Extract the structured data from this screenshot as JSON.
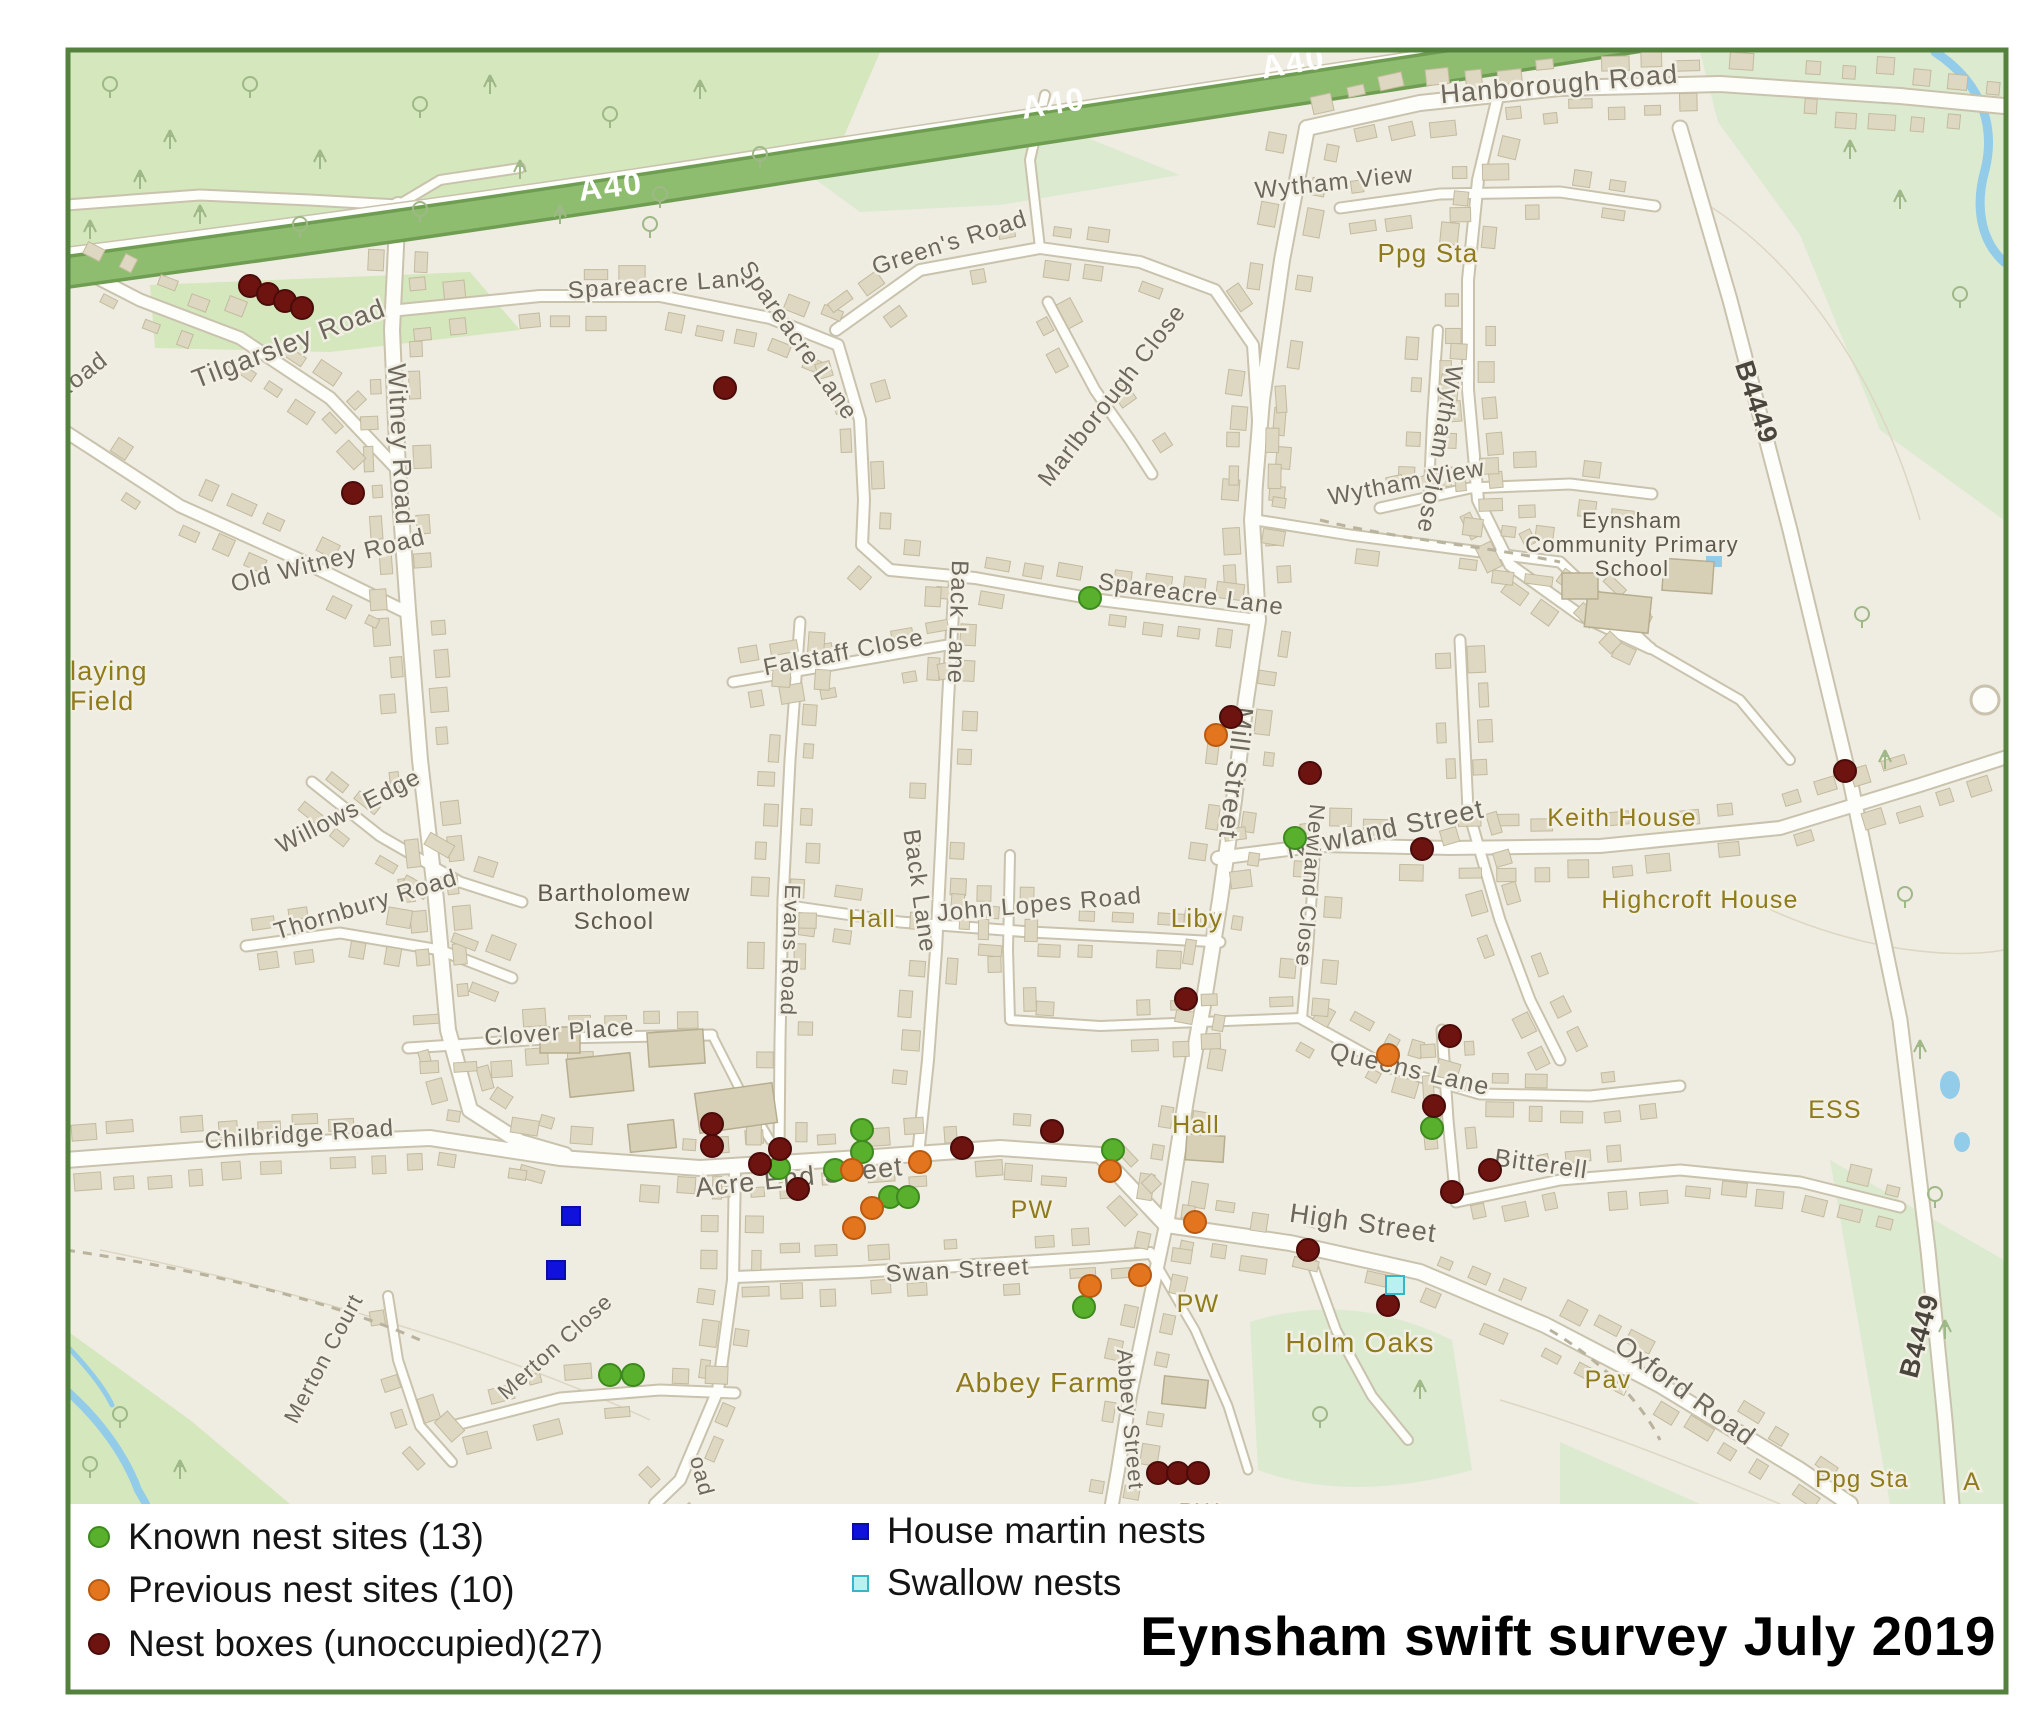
{
  "title": "Eynsham swift survey July 2019",
  "legend": {
    "items": [
      {
        "id": "known",
        "label": "Known nest sites (13)",
        "shape": "circle",
        "color": "#58b02c",
        "border": "#3e8a1e"
      },
      {
        "id": "previous",
        "label": "Previous nest sites (10)",
        "shape": "circle",
        "color": "#e4751f",
        "border": "#b85a10"
      },
      {
        "id": "nestbox",
        "label": "Nest boxes (unoccupied)(27)",
        "shape": "circle",
        "color": "#6d1310",
        "border": "#4a0c0a"
      },
      {
        "id": "housemartin",
        "label": "House martin nests",
        "shape": "square",
        "color": "#1012dc",
        "border": "#0b0da8"
      },
      {
        "id": "swallow",
        "label": "Swallow nests",
        "shape": "square",
        "color": "#b9f0f2",
        "border": "#35b6c9"
      }
    ]
  },
  "map": {
    "labels": [
      {
        "t": "A40",
        "x": 612,
        "y": 197,
        "r": -7,
        "c": "route",
        "s": 32
      },
      {
        "t": "A40",
        "x": 1055,
        "y": 114,
        "r": -9,
        "c": "route",
        "s": 32
      },
      {
        "t": "A40",
        "x": 1295,
        "y": 73,
        "r": -10,
        "c": "route",
        "s": 32
      },
      {
        "t": "B4449",
        "x": 1748,
        "y": 405,
        "r": 72,
        "c": "ref",
        "s": 27
      },
      {
        "t": "B4449",
        "x": 1928,
        "y": 1338,
        "r": -75,
        "c": "ref",
        "s": 27
      },
      {
        "t": "Hanborough Road",
        "x": 1560,
        "y": 93,
        "r": -5,
        "c": "street",
        "s": 27
      },
      {
        "t": "Wytham View",
        "x": 1335,
        "y": 190,
        "r": -6,
        "c": "street",
        "s": 24
      },
      {
        "t": "Wytham Close",
        "x": 1432,
        "y": 448,
        "r": 100,
        "c": "street",
        "s": 24
      },
      {
        "t": "Wytham View",
        "x": 1408,
        "y": 490,
        "r": -11,
        "c": "street",
        "s": 24
      },
      {
        "t": "Green's Road",
        "x": 952,
        "y": 250,
        "r": -18,
        "c": "street",
        "s": 24
      },
      {
        "t": "Spareacre Lane",
        "x": 662,
        "y": 292,
        "r": -4,
        "c": "street",
        "s": 24
      },
      {
        "t": "Spareacre Lane",
        "x": 792,
        "y": 345,
        "r": 55,
        "c": "street",
        "s": 24
      },
      {
        "t": "Marlborough Close",
        "x": 1118,
        "y": 400,
        "r": -52,
        "c": "street",
        "s": 24
      },
      {
        "t": "Tilgarsley Road",
        "x": 292,
        "y": 352,
        "r": -21,
        "c": "street",
        "s": 27
      },
      {
        "t": "Witney Road",
        "x": 392,
        "y": 445,
        "r": 87,
        "c": "street",
        "s": 26
      },
      {
        "t": "Road",
        "x": 85,
        "y": 382,
        "r": -38,
        "c": "street",
        "s": 24
      },
      {
        "t": "Old Witney Road",
        "x": 330,
        "y": 568,
        "r": -14,
        "c": "street",
        "s": 24
      },
      {
        "t": "laying",
        "x": 70,
        "y": 680,
        "r": 0,
        "c": "poi",
        "s": 27,
        "a": "start"
      },
      {
        "t": "Field",
        "x": 70,
        "y": 710,
        "r": 0,
        "c": "poi",
        "s": 27,
        "a": "start"
      },
      {
        "t": "Willows Edge",
        "x": 352,
        "y": 818,
        "r": -27,
        "c": "street",
        "s": 24
      },
      {
        "t": "Thornbury Road",
        "x": 368,
        "y": 912,
        "r": -17,
        "c": "street",
        "s": 24
      },
      {
        "t": "Falstaff Close",
        "x": 845,
        "y": 660,
        "r": -11,
        "c": "street",
        "s": 24
      },
      {
        "t": "Back Lane",
        "x": 950,
        "y": 622,
        "r": 92,
        "c": "street",
        "s": 24
      },
      {
        "t": "Back Lane",
        "x": 912,
        "y": 892,
        "r": 82,
        "c": "street",
        "s": 24
      },
      {
        "t": "Spareacre Lane",
        "x": 1190,
        "y": 602,
        "r": 8,
        "c": "street",
        "s": 24
      },
      {
        "t": "Mill Street",
        "x": 1227,
        "y": 772,
        "r": 97,
        "c": "street",
        "s": 27
      },
      {
        "t": "John Lopes Road",
        "x": 1040,
        "y": 912,
        "r": -5,
        "c": "street",
        "s": 24
      },
      {
        "t": "Liby",
        "x": 1197,
        "y": 927,
        "r": 0,
        "c": "poi",
        "s": 26
      },
      {
        "t": "Newland Street",
        "x": 1387,
        "y": 838,
        "r": -12,
        "c": "street",
        "s": 27
      },
      {
        "t": "Newland Close",
        "x": 1303,
        "y": 885,
        "r": 95,
        "c": "street",
        "s": 22
      },
      {
        "t": "Evans Road",
        "x": 783,
        "y": 950,
        "r": 92,
        "c": "street",
        "s": 22
      },
      {
        "t": "Keith House",
        "x": 1622,
        "y": 826,
        "r": 0,
        "c": "poi",
        "s": 25
      },
      {
        "t": "Highcroft House",
        "x": 1700,
        "y": 908,
        "r": 0,
        "c": "poi",
        "s": 25
      },
      {
        "t": "Bartholomew",
        "x": 614,
        "y": 901,
        "r": 0,
        "c": "school",
        "s": 24
      },
      {
        "t": "School",
        "x": 614,
        "y": 929,
        "r": 0,
        "c": "school",
        "s": 24
      },
      {
        "t": "Eynsham",
        "x": 1632,
        "y": 528,
        "r": 0,
        "c": "school",
        "s": 22
      },
      {
        "t": "Community Primary",
        "x": 1632,
        "y": 552,
        "r": 0,
        "c": "school",
        "s": 22
      },
      {
        "t": "School",
        "x": 1632,
        "y": 576,
        "r": 0,
        "c": "school",
        "s": 22
      },
      {
        "t": "Hall",
        "x": 872,
        "y": 927,
        "r": 0,
        "c": "poi",
        "s": 25
      },
      {
        "t": "Hall",
        "x": 1196,
        "y": 1133,
        "r": 0,
        "c": "poi",
        "s": 25
      },
      {
        "t": "Clover Place",
        "x": 560,
        "y": 1040,
        "r": -4,
        "c": "street",
        "s": 24
      },
      {
        "t": "Chilbridge Road",
        "x": 300,
        "y": 1142,
        "r": -4,
        "c": "street",
        "s": 24
      },
      {
        "t": "Acre End Street",
        "x": 800,
        "y": 1186,
        "r": -6,
        "c": "street",
        "s": 27
      },
      {
        "t": "Queens Lane",
        "x": 1408,
        "y": 1077,
        "r": 13,
        "c": "street",
        "s": 25
      },
      {
        "t": "ESS",
        "x": 1835,
        "y": 1118,
        "r": 0,
        "c": "poi",
        "s": 25
      },
      {
        "t": "Bitterell",
        "x": 1540,
        "y": 1172,
        "r": 8,
        "c": "street",
        "s": 25
      },
      {
        "t": "High Street",
        "x": 1362,
        "y": 1232,
        "r": 8,
        "c": "street",
        "s": 27
      },
      {
        "t": "PW",
        "x": 1032,
        "y": 1218,
        "r": 0,
        "c": "poi",
        "s": 25
      },
      {
        "t": "Swan Street",
        "x": 958,
        "y": 1278,
        "r": -3,
        "c": "street",
        "s": 24
      },
      {
        "t": "PW",
        "x": 1198,
        "y": 1312,
        "r": 0,
        "c": "poi",
        "s": 25
      },
      {
        "t": "Holm Oaks",
        "x": 1360,
        "y": 1352,
        "r": 0,
        "c": "poi",
        "s": 28
      },
      {
        "t": "Abbey Farm",
        "x": 1038,
        "y": 1392,
        "r": 0,
        "c": "poi",
        "s": 28
      },
      {
        "t": "Merton Court",
        "x": 330,
        "y": 1362,
        "r": -62,
        "c": "street",
        "s": 22
      },
      {
        "t": "Merton Close",
        "x": 560,
        "y": 1352,
        "r": -42,
        "c": "street",
        "s": 22
      },
      {
        "t": "Abbey Street",
        "x": 1123,
        "y": 1420,
        "r": 85,
        "c": "street",
        "s": 22
      },
      {
        "t": "oad",
        "x": 695,
        "y": 1478,
        "r": 75,
        "c": "street",
        "s": 22
      },
      {
        "t": "Oxford Road",
        "x": 1680,
        "y": 1398,
        "r": 36,
        "c": "street",
        "s": 27
      },
      {
        "t": "Pav",
        "x": 1608,
        "y": 1388,
        "r": 0,
        "c": "poi",
        "s": 25
      },
      {
        "t": "Ppg Sta",
        "x": 1428,
        "y": 262,
        "r": 0,
        "c": "poi",
        "s": 26
      },
      {
        "t": "Ppg Sta",
        "x": 1862,
        "y": 1487,
        "r": 0,
        "c": "poi",
        "s": 24
      },
      {
        "t": "A",
        "x": 1972,
        "y": 1490,
        "r": 0,
        "c": "poi",
        "s": 25
      },
      {
        "t": "PW",
        "x": 1199,
        "y": 1520,
        "r": 0,
        "c": "poi",
        "s": 24
      }
    ],
    "markers": {
      "known": {
        "color": "#58b02c",
        "border": "#3e8a1e",
        "shape": "circle",
        "points": [
          [
            1090,
            598
          ],
          [
            1295,
            838
          ],
          [
            1432,
            1128
          ],
          [
            862,
            1130
          ],
          [
            862,
            1152
          ],
          [
            835,
            1170
          ],
          [
            779,
            1168
          ],
          [
            890,
            1197
          ],
          [
            908,
            1197
          ],
          [
            1113,
            1150
          ],
          [
            1084,
            1307
          ],
          [
            610,
            1375
          ],
          [
            633,
            1375
          ]
        ]
      },
      "previous": {
        "color": "#e4751f",
        "border": "#b85a10",
        "shape": "circle",
        "points": [
          [
            1216,
            735
          ],
          [
            1388,
            1055
          ],
          [
            852,
            1170
          ],
          [
            920,
            1162
          ],
          [
            872,
            1208
          ],
          [
            854,
            1228
          ],
          [
            1110,
            1171
          ],
          [
            1195,
            1222
          ],
          [
            1140,
            1275
          ],
          [
            1090,
            1286
          ]
        ]
      },
      "nestbox": {
        "color": "#6d1310",
        "border": "#4a0c0a",
        "shape": "circle",
        "points": [
          [
            250,
            286
          ],
          [
            268,
            294
          ],
          [
            285,
            301
          ],
          [
            302,
            308
          ],
          [
            725,
            388
          ],
          [
            353,
            493
          ],
          [
            1231,
            717
          ],
          [
            1310,
            773
          ],
          [
            1845,
            771
          ],
          [
            1422,
            849
          ],
          [
            1186,
            999
          ],
          [
            1450,
            1036
          ],
          [
            712,
            1124
          ],
          [
            712,
            1146
          ],
          [
            780,
            1149
          ],
          [
            760,
            1164
          ],
          [
            798,
            1189
          ],
          [
            962,
            1148
          ],
          [
            1052,
            1131
          ],
          [
            1434,
            1106
          ],
          [
            1490,
            1170
          ],
          [
            1452,
            1192
          ],
          [
            1308,
            1250
          ],
          [
            1388,
            1305
          ],
          [
            1158,
            1473
          ],
          [
            1178,
            1473
          ],
          [
            1198,
            1473
          ]
        ]
      },
      "housemartin": {
        "color": "#1012dc",
        "border": "#0b0da8",
        "shape": "square",
        "points": [
          [
            571,
            1216
          ],
          [
            556,
            1270
          ]
        ]
      },
      "swallow": {
        "color": "#b9f0f2",
        "border": "#35b6c9",
        "shape": "square",
        "points": [
          [
            1395,
            1285
          ]
        ]
      }
    }
  }
}
